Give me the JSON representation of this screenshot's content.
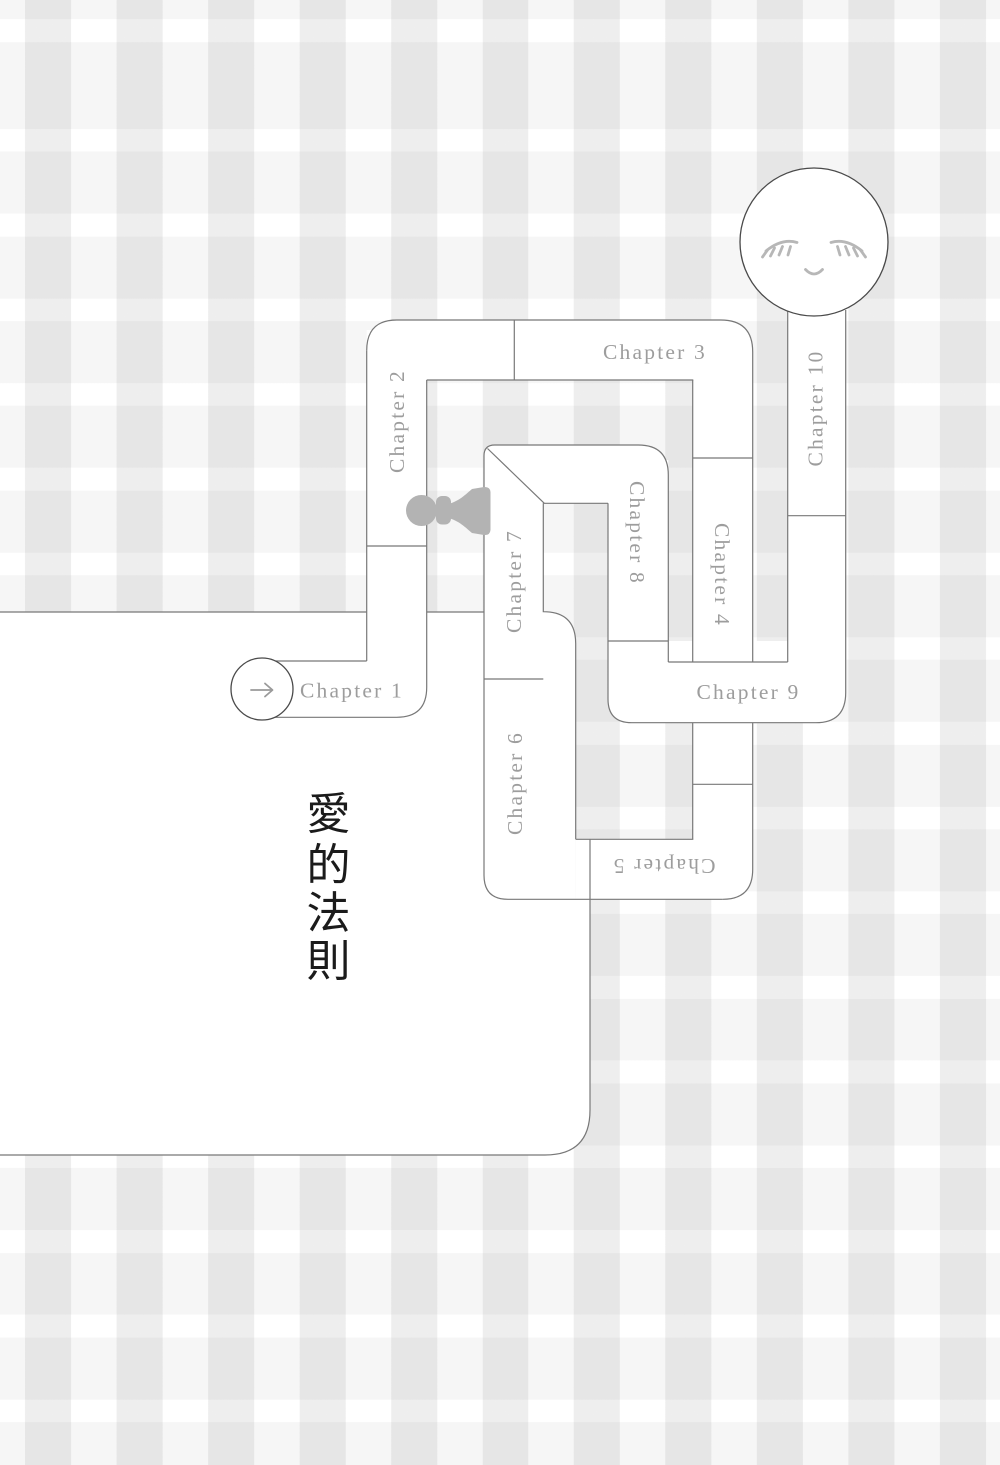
{
  "title": {
    "text": "愛的法則",
    "chars": [
      "愛",
      "的",
      "法",
      "則"
    ]
  },
  "board": {
    "start_icon": "right-arrow",
    "goal_icon": "sleeping-face",
    "piece_icon": "pawn"
  },
  "chapters": [
    {
      "label": "Chapter 1"
    },
    {
      "label": "Chapter 2"
    },
    {
      "label": "Chapter 3"
    },
    {
      "label": "Chapter 4"
    },
    {
      "label": "Chapter 5"
    },
    {
      "label": "Chapter 6"
    },
    {
      "label": "Chapter 7"
    },
    {
      "label": "Chapter 8"
    },
    {
      "label": "Chapter 9"
    },
    {
      "label": "Chapter 10"
    }
  ],
  "colors": {
    "background": "#ffffff",
    "plaid_column": "#ededed",
    "plaid_row": "#f5f5f5",
    "path_line": "#787878",
    "node_line": "#4a4a4a",
    "label_gray": "#9d9d9d",
    "title_black": "#1b1b1b",
    "piece_gray": "#b3b3b3"
  }
}
